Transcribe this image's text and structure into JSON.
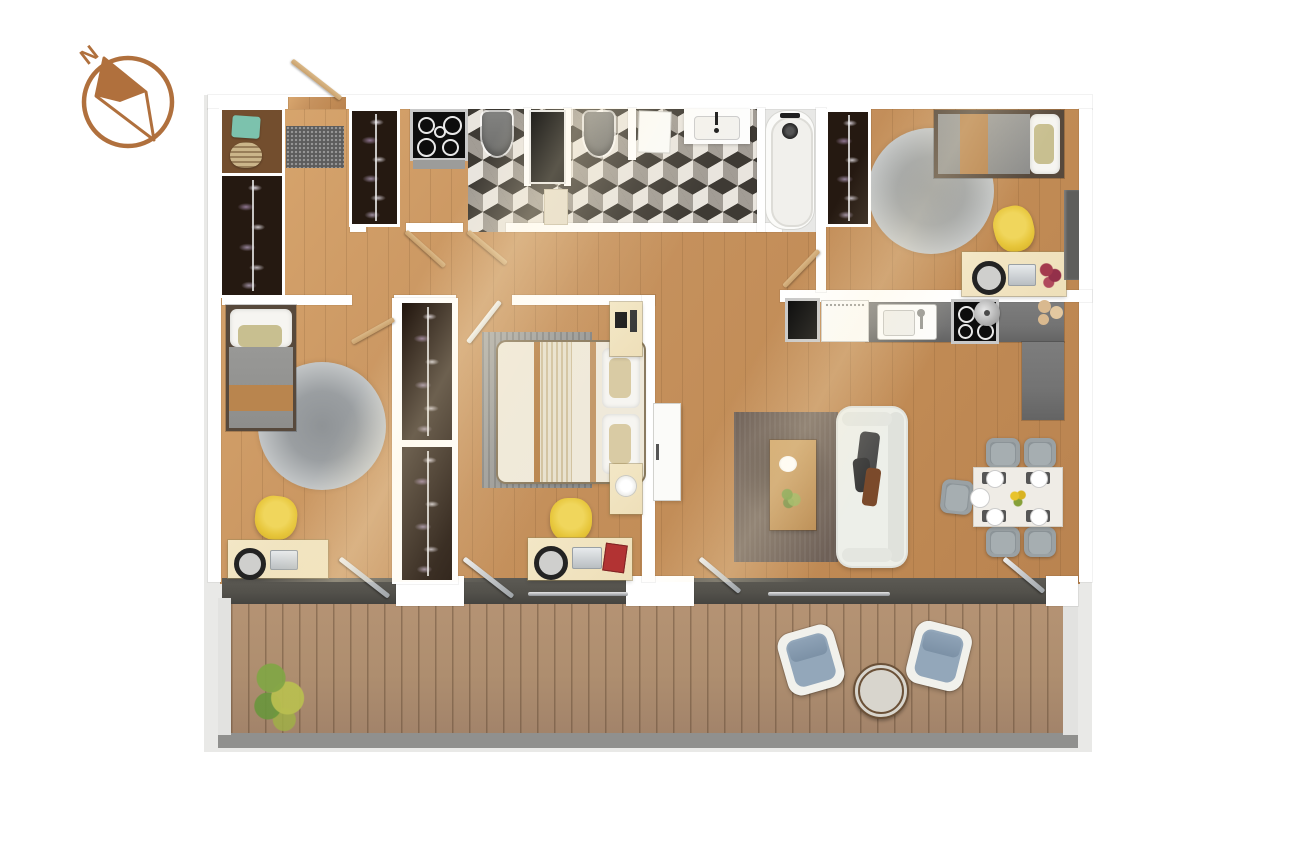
{
  "compass": {
    "label": "N",
    "icon": "compass-north-icon"
  },
  "palette": {
    "wood": "#c6925e",
    "wood_light": "#d9a76f",
    "deck": "#ae8e6f",
    "wall": "#ffffff",
    "shell": "#e9e9e7",
    "track": "#53514b",
    "counter": "#737373",
    "tile_dark": "#3e3a34",
    "tile_light": "#e9e5de",
    "wardrobe": "#251911",
    "accent_yellow": "#e7c63b",
    "sofa": "#edefe9",
    "rug_brown": "#6e6057",
    "rug_gray_outer": "#d3d5d6",
    "rug_gray_inner": "#8f9396",
    "bed_gray": "#8e8e8c",
    "bed_tan": "#b9854e",
    "teal": "#7cc2ad",
    "door_wood": "#c9a16d",
    "compass": "#b0703d",
    "cushion_blue": "#93a7ba",
    "desk": "#eedfb9",
    "dark_appliance": "#0d0d0d"
  }
}
